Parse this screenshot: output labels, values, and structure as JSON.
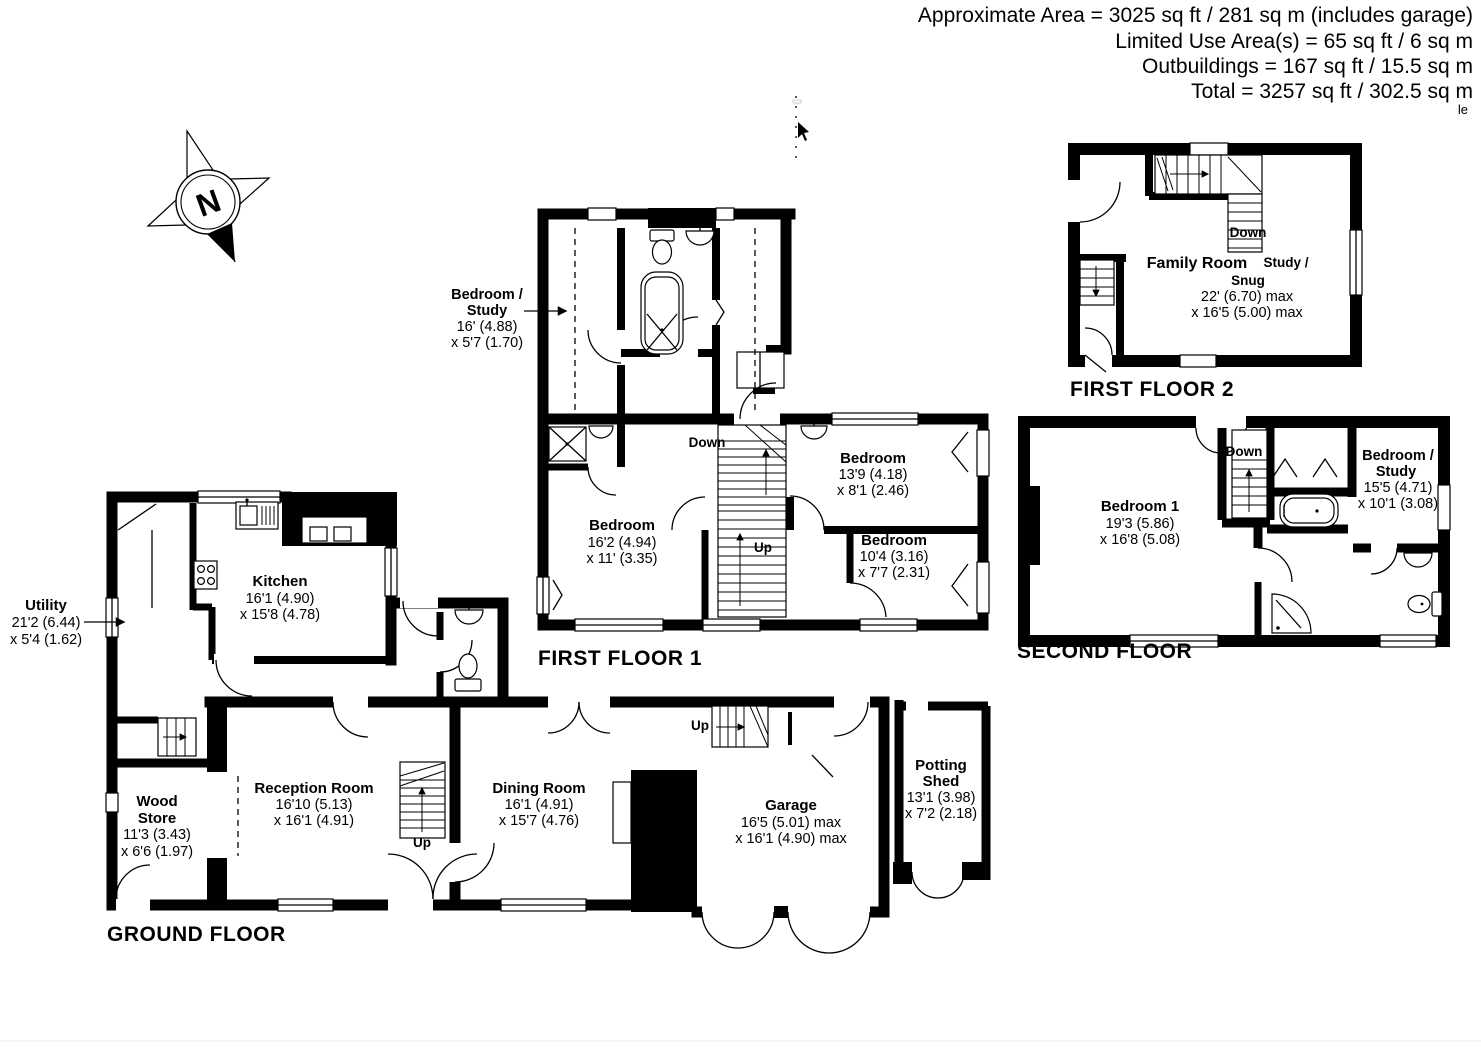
{
  "summary": {
    "line1": "Approximate Area = 3025 sq ft / 281 sq m (includes garage)",
    "line2": "Limited Use Area(s) = 65 sq ft / 6 sq m",
    "line3": "Outbuildings = 167 sq ft / 15.5 sq m",
    "line4": "Total = 3257 sq ft / 302.5 sq m",
    "corner_fragment": "le"
  },
  "compass": {
    "north": "N"
  },
  "floors": {
    "ground": {
      "title": "GROUND FLOOR",
      "rooms": {
        "utility": {
          "name": "Utility",
          "dim1": "21'2 (6.44)",
          "dim2": "x 5'4 (1.62)"
        },
        "kitchen": {
          "name": "Kitchen",
          "dim1": "16'1 (4.90)",
          "dim2": "x 15'8 (4.78)"
        },
        "wood_store": {
          "name1": "Wood",
          "name2": "Store",
          "dim1": "11'3 (3.43)",
          "dim2": "x 6'6 (1.97)"
        },
        "reception": {
          "name": "Reception Room",
          "dim1": "16'10 (5.13)",
          "dim2": "x 16'1 (4.91)"
        },
        "dining": {
          "name": "Dining Room",
          "dim1": "16'1 (4.91)",
          "dim2": "x 15'7 (4.76)"
        },
        "garage": {
          "name": "Garage",
          "dim1": "16'5 (5.01) max",
          "dim2": "x 16'1 (4.90) max"
        },
        "potting_shed": {
          "name1": "Potting",
          "name2": "Shed",
          "dim1": "13'1 (3.98)",
          "dim2": "x 7'2 (2.18)"
        }
      },
      "stairs": {
        "up_reception": "Up",
        "up_garage": "Up"
      }
    },
    "first1": {
      "title": "FIRST FLOOR 1",
      "rooms": {
        "bedroom_study": {
          "name1": "Bedroom  /",
          "name2": "Study",
          "dim1": "16' (4.88)",
          "dim2": "x 5'7 (1.70)"
        },
        "bedroom_left": {
          "name": "Bedroom",
          "dim1": "16'2 (4.94)",
          "dim2": "x 11' (3.35)"
        },
        "bedroom_top_right": {
          "name": "Bedroom",
          "dim1": "13'9 (4.18)",
          "dim2": "x 8'1 (2.46)"
        },
        "bedroom_bot_right": {
          "name": "Bedroom",
          "dim1": "10'4 (3.16)",
          "dim2": "x 7'7 (2.31)"
        }
      },
      "stairs": {
        "down": "Down",
        "up": "Up"
      }
    },
    "first2": {
      "title": "FIRST FLOOR 2",
      "rooms": {
        "family_room": {
          "name1": "Family Room",
          "name2": "Study /",
          "name3": "Snug",
          "dim1": "22' (6.70) max",
          "dim2": "x 16'5 (5.00) max"
        }
      },
      "stairs": {
        "down": "Down"
      }
    },
    "second": {
      "title": "SECOND FLOOR",
      "rooms": {
        "bedroom1": {
          "name": "Bedroom 1",
          "dim1": "19'3 (5.86)",
          "dim2": "x 16'8 (5.08)"
        },
        "bedroom_study": {
          "name1": "Bedroom   /",
          "name2": "Study",
          "dim1": "15'5 (4.71)",
          "dim2": "x 10'1 (3.08)"
        }
      },
      "stairs": {
        "down": "Down"
      }
    }
  }
}
